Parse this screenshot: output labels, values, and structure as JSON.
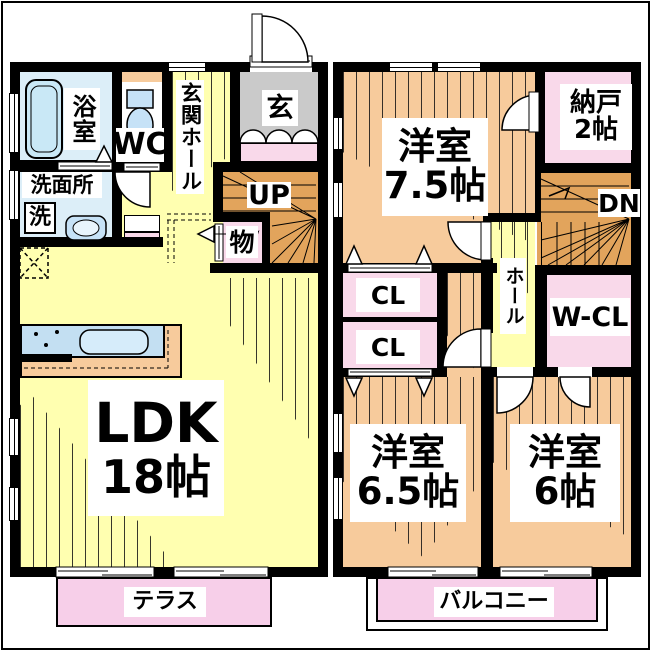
{
  "colors": {
    "wall": "#000000",
    "ldk_yellow": "#FFFFB0",
    "bedroom_peach": "#F7CB9C",
    "closet_pink": "#F9D9EA",
    "terrace_pink": "#F7CFE9",
    "entry_gray": "#CACACA",
    "stairs_orange": "#E2A45C",
    "bath_blue": "#DCEEF8",
    "fixture_blue": "#C3DFF2"
  },
  "floor1": {
    "bath": "浴室",
    "wc": "WC",
    "washroom": "洗面所",
    "washer": "洗",
    "entrance_hall": "玄関ホール",
    "entrance": "玄",
    "stairs_up": "UP",
    "storage": "物",
    "ldk_name": "LDK",
    "ldk_size": "18帖",
    "terrace": "テラス"
  },
  "floor2": {
    "bedroom1_name": "洋室",
    "bedroom1_size": "7.5帖",
    "storeroom_name": "納戸",
    "storeroom_size": "2帖",
    "stairs_down": "DN",
    "hall": "ホール",
    "closet1": "CL",
    "closet2": "CL",
    "walk_in_closet": "W-CL",
    "bedroom2_name": "洋室",
    "bedroom2_size": "6.5帖",
    "bedroom3_name": "洋室",
    "bedroom3_size": "6帖",
    "balcony": "バルコニー"
  }
}
